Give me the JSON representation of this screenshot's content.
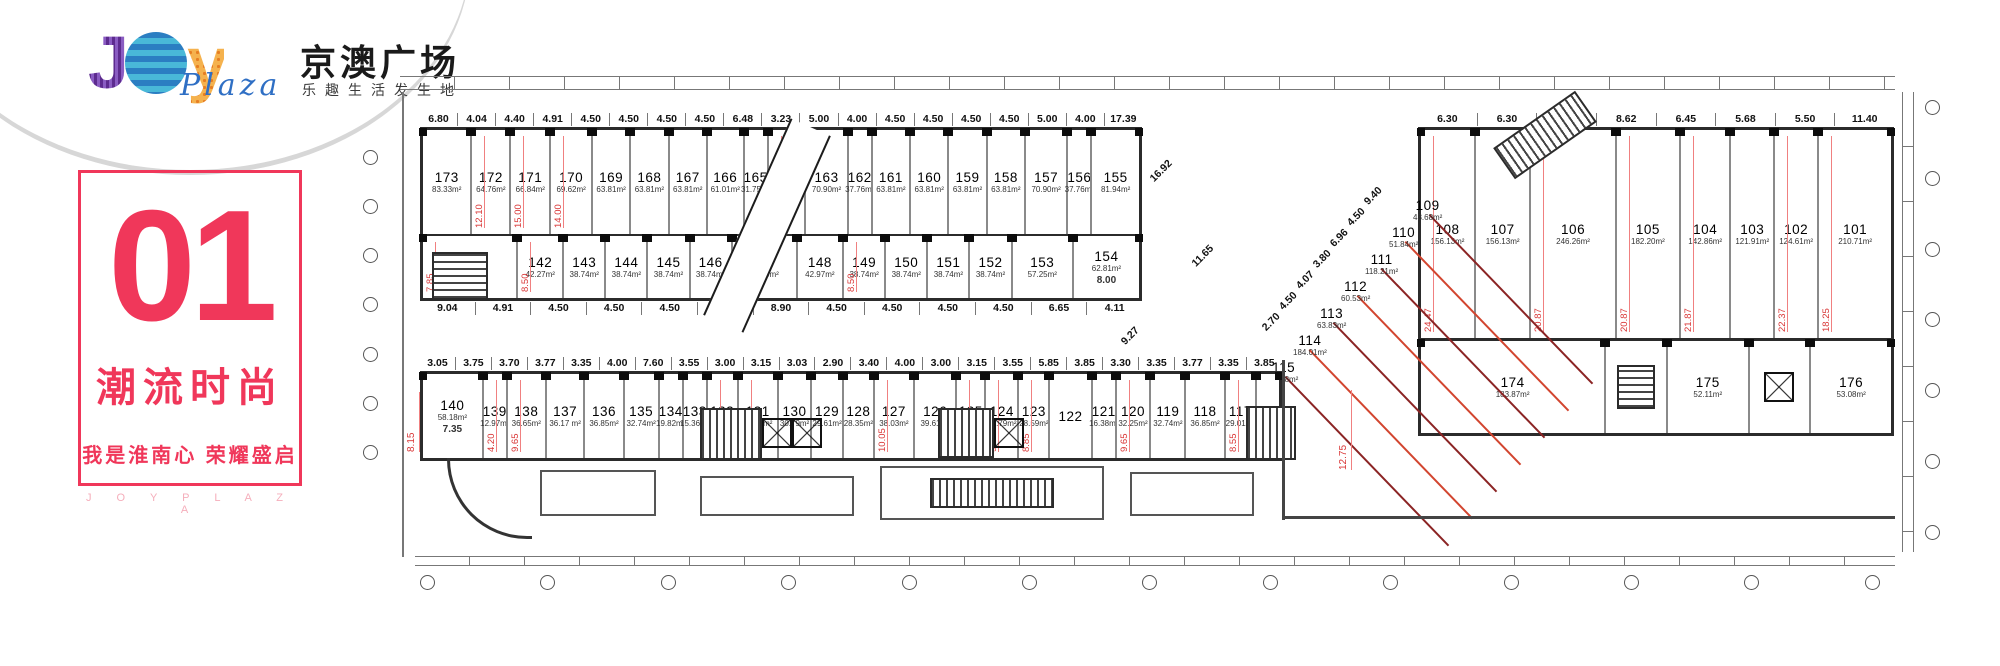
{
  "brand": {
    "logo_joy_j": "J",
    "logo_joy_o": "",
    "logo_joy_y": "y",
    "logo_plaza_script": "Plaza",
    "logo_cn": "京澳广场",
    "logo_tagline": "乐趣生活发生地",
    "floor_number": "01",
    "floor_badge": "层",
    "slogan_main": "潮流时尚",
    "slogan_sub": "我是淮南心  荣耀盛启",
    "slogan_en": "J O Y   P L A Z A"
  },
  "colors": {
    "accent_red": "#f0375a",
    "badge_cyan": "#3ec9e6",
    "dim_red": "#d93636",
    "dim_pink": "#f08080",
    "dark_red_line": "#8b2424",
    "wall_dark": "#222222",
    "wall_gray": "#8a8a8a",
    "logo_purple": "#5d2b8f",
    "logo_blue": "#2b7ec2",
    "logo_orange": "#f2a33c",
    "plaza_blue": "#2f6fc4"
  },
  "icons": {
    "elevator": "crossed-box",
    "stair": "hatched-box",
    "escalator": "hatched-box-rotated",
    "floor_badge": "cyan-diamond"
  },
  "plan": {
    "top_block": {
      "dims_top": [
        "6.80",
        "4.04",
        "4.40",
        "4.91",
        "4.50",
        "4.50",
        "4.50",
        "4.50",
        "6.48",
        "3.23",
        "5.00",
        "4.00",
        "4.50",
        "4.50",
        "4.50",
        "4.50",
        "5.00",
        "4.00",
        "17.39"
      ],
      "dims_bottom": [
        "9.04",
        "4.91",
        "4.50",
        "4.50",
        "4.50",
        "4.50",
        "8.90",
        "4.50",
        "4.50",
        "4.50",
        "4.50",
        "6.65",
        "4.11"
      ],
      "row1": [
        {
          "no": "173",
          "area": "83.33m²"
        },
        {
          "no": "172",
          "area": "64.76m²",
          "vdim": "12.10"
        },
        {
          "no": "171",
          "area": "66.84m²",
          "vdim": "15.00"
        },
        {
          "no": "170",
          "area": "69.62m²",
          "vdim": "14.00"
        },
        {
          "no": "169",
          "area": "63.81m²"
        },
        {
          "no": "168",
          "area": "63.81m²"
        },
        {
          "no": "167",
          "area": "63.81m²"
        },
        {
          "no": "166",
          "area": "61.01m²"
        },
        {
          "no": "165",
          "area": "31.75m²"
        },
        {
          "no": "164",
          "area": "62.88m²",
          "vdim": "14.00"
        },
        {
          "no": "163",
          "area": "70.90m²"
        },
        {
          "no": "162",
          "area": "37.76m²"
        },
        {
          "no": "161",
          "area": "63.81m²"
        },
        {
          "no": "160",
          "area": "63.81m²"
        },
        {
          "no": "159",
          "area": "63.81m²"
        },
        {
          "no": "158",
          "area": "63.81m²"
        },
        {
          "no": "157",
          "area": "70.90m²"
        },
        {
          "no": "156",
          "area": "37.76m²"
        },
        {
          "no": "155",
          "area": "81.94m²"
        }
      ],
      "row2": [
        {
          "no": "141",
          "area": "90.16m²",
          "vdim": "7.85"
        },
        {
          "no": "142",
          "area": "42.27m²",
          "vdim": "8.50"
        },
        {
          "no": "143",
          "area": "38.74m²"
        },
        {
          "no": "144",
          "area": "38.74m²"
        },
        {
          "no": "145",
          "area": "38.74m²"
        },
        {
          "no": "146",
          "area": "38.74m²"
        },
        {
          "no": "147",
          "area": "60.75m²"
        },
        {
          "no": "148",
          "area": "42.97m²"
        },
        {
          "no": "149",
          "area": "38.74m²",
          "vdim": "8.50"
        },
        {
          "no": "150",
          "area": "38.74m²"
        },
        {
          "no": "151",
          "area": "38.74m²"
        },
        {
          "no": "152",
          "area": "38.74m²"
        },
        {
          "no": "153",
          "area": "57.25m²"
        },
        {
          "no": "154",
          "area": "62.81m²",
          "hdim": "8.00"
        }
      ]
    },
    "right_block": {
      "dims_top": [
        "6.30",
        "6.30",
        "11.15",
        "8.62",
        "6.45",
        "5.68",
        "5.50",
        "11.40"
      ],
      "row": [
        {
          "no": "108",
          "area": "156.13m²",
          "vdim": "24.47"
        },
        {
          "no": "107",
          "area": "156.13m²"
        },
        {
          "no": "106",
          "area": "246.26m²",
          "vdim": "20.87"
        },
        {
          "no": "105",
          "area": "182.20m²",
          "vdim": "20.87"
        },
        {
          "no": "104",
          "area": "142.86m²",
          "vdim": "21.87"
        },
        {
          "no": "103",
          "area": "121.91m²"
        },
        {
          "no": "102",
          "area": "124.61m²",
          "vdim": "22.37"
        },
        {
          "no": "101",
          "area": "210.71m²",
          "vdim": "18.25"
        }
      ],
      "lower": [
        {
          "no": "174",
          "area": "183.87m²"
        },
        {
          "no": "175",
          "area": "52.11m²"
        },
        {
          "no": "176",
          "area": "53.08m²"
        }
      ]
    },
    "diagonal": {
      "dims": [
        "9.40",
        "4.50",
        "6.96",
        "3.80",
        "4.07",
        "4.50",
        "2.70"
      ],
      "corridor_dims": [
        "16.92",
        "11.65",
        "9.27"
      ],
      "units": [
        {
          "no": "109",
          "area": "43.68m²"
        },
        {
          "no": "110",
          "area": "51.84m²"
        },
        {
          "no": "111",
          "area": "118.21m²"
        },
        {
          "no": "112",
          "area": "60.53m²"
        },
        {
          "no": "113",
          "area": "63.83m²"
        },
        {
          "no": "114",
          "area": "184.01m²"
        },
        {
          "no": "115",
          "area": "27.78m²"
        }
      ]
    },
    "bottom_strip": {
      "dims_top": [
        "3.05",
        "3.75",
        "3.70",
        "3.77",
        "3.35",
        "4.00",
        "7.60",
        "3.55",
        "3.00",
        "3.15",
        "3.03",
        "2.90",
        "3.40",
        "4.00",
        "3.00",
        "3.15",
        "3.55",
        "5.85",
        "3.85",
        "3.30",
        "3.35",
        "3.77",
        "3.35",
        "3.85"
      ],
      "units": [
        {
          "no": "140",
          "area": "58.18m²",
          "hdim": "7.35"
        },
        {
          "no": "139",
          "area": "12.97m²",
          "vdim": "4.20"
        },
        {
          "no": "138",
          "area": "36.65m²",
          "vdim": "9.65"
        },
        {
          "no": "137",
          "area": "36.17 m²"
        },
        {
          "no": "136",
          "area": "36.85m²"
        },
        {
          "no": "135",
          "area": "32.74m²"
        },
        {
          "no": "134",
          "area": "19.82m²"
        },
        {
          "no": "133",
          "area": "15.36m²"
        },
        {
          "no": "132",
          "area": "28.55m²",
          "vdim": "8.85"
        },
        {
          "no": "131",
          "area": "38.03m²",
          "vdim": "9.65"
        },
        {
          "no": "130",
          "area": "30.79m²"
        },
        {
          "no": "129",
          "area": "29.61m²"
        },
        {
          "no": "128",
          "area": "28.35m²"
        },
        {
          "no": "127",
          "area": "38.03m²",
          "vdim": "10.05"
        },
        {
          "no": "126",
          "area": "39.61m²"
        },
        {
          "no": "125",
          "area": "26.89m²",
          "vdim": "8.85"
        },
        {
          "no": "124",
          "area": "30.79m²",
          "vdim": "9.65"
        },
        {
          "no": "123",
          "area": "28.59m²",
          "vdim": "8.85"
        },
        {
          "no": "122",
          "area": ""
        },
        {
          "no": "121",
          "area": "16.38m²"
        },
        {
          "no": "120",
          "area": "32.25m²",
          "vdim": "9.65"
        },
        {
          "no": "119",
          "area": "32.74m²"
        },
        {
          "no": "118",
          "area": "36.85m²"
        },
        {
          "no": "117",
          "area": "29.01m²",
          "vdim": "8.55"
        },
        {
          "no": "116",
          "area": "16.38m²"
        }
      ]
    },
    "extra_dims": {
      "center_vertical": "12.75",
      "strip_left_vertical": "8.15"
    }
  }
}
